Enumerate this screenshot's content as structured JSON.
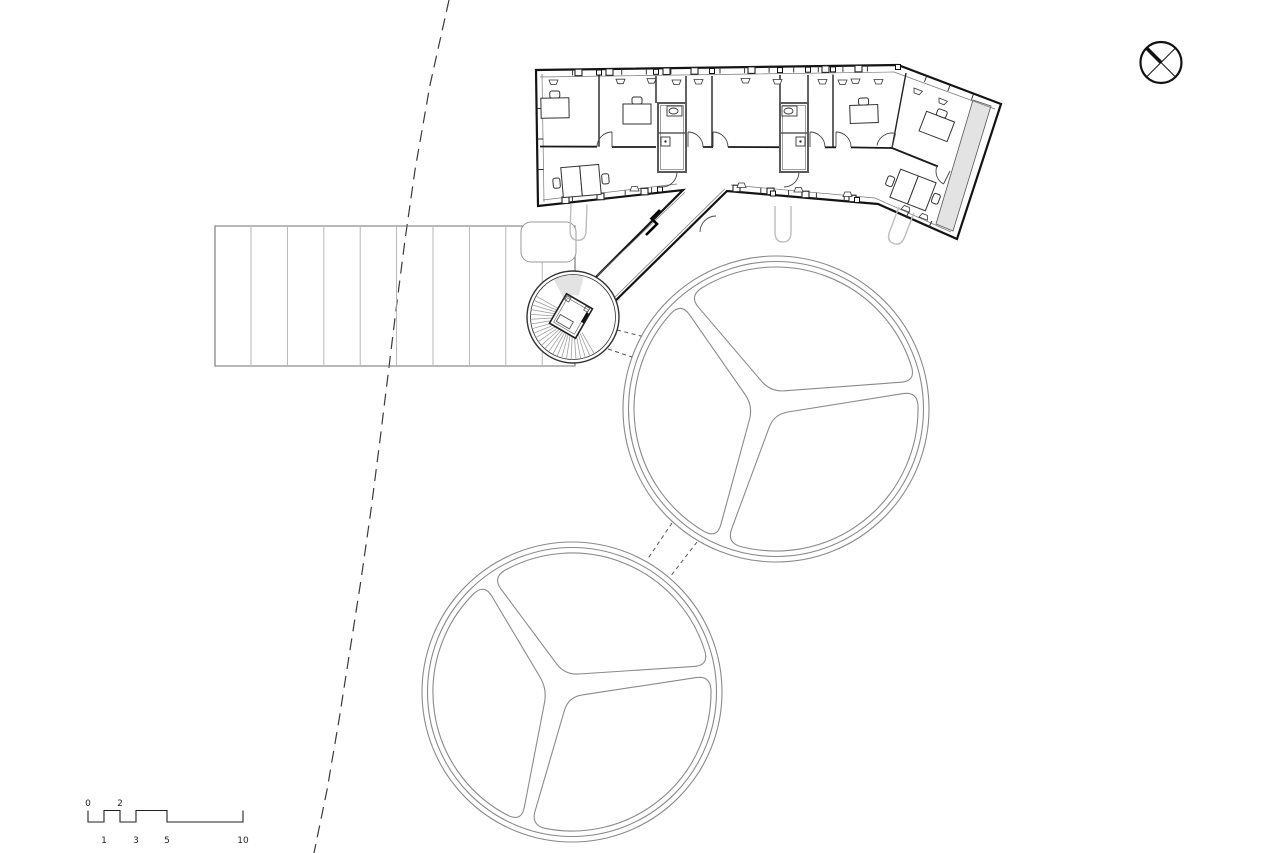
{
  "drawing": {
    "kind": "architectural-site-floor-plan",
    "background": "#ffffff"
  },
  "colors": {
    "wall": "#141414",
    "partition": "#222222",
    "pod_wall": "#5a5a5a",
    "canopy_line": "#8a8a8a",
    "deck_border": "#707070",
    "deck_plank": "#b0b0b0",
    "stair_tread": "#9a9a9a",
    "column_gray": "#bdbdbd",
    "gray_fill": "#e3e3e3",
    "boundary_dash": "#3a3a3a"
  },
  "elements": {
    "building": "office-wing",
    "tower": "spiral-stair-tower",
    "deck": "timber-deck",
    "canopies": "circular-canopy",
    "boundary": "site-boundary-line",
    "north": "north-arrow"
  },
  "scale_bar": {
    "top_labels": [
      "0",
      "2"
    ],
    "bottom_labels": [
      "1",
      "3",
      "5",
      "10"
    ]
  }
}
